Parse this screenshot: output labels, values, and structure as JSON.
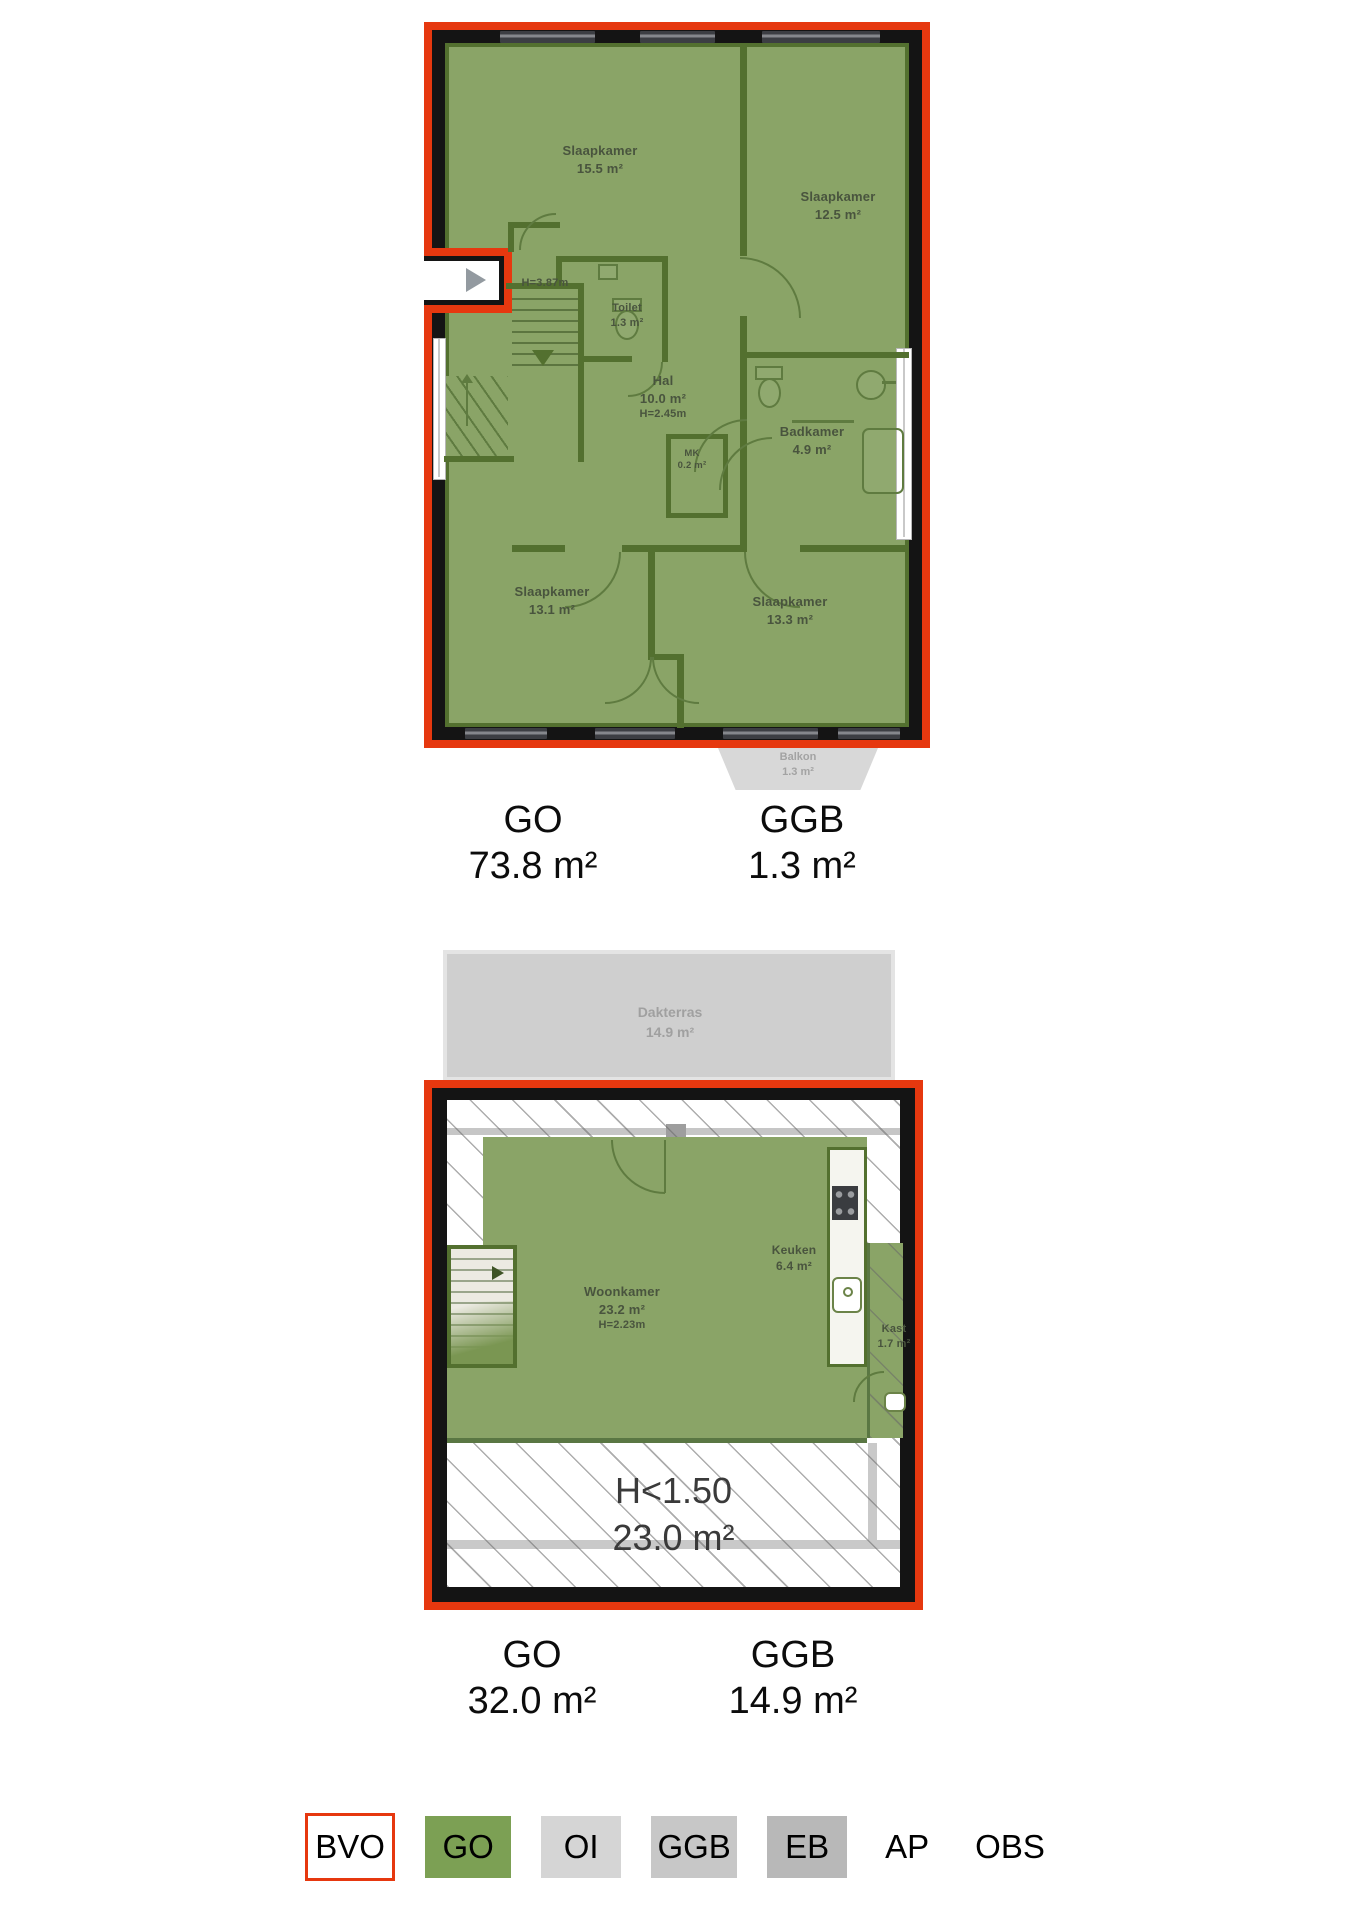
{
  "floor1": {
    "rooms": [
      {
        "name": "Slaapkamer",
        "area": "15.5 m²"
      },
      {
        "name": "Slaapkamer",
        "area": "12.5 m²"
      },
      {
        "name": "Toilet",
        "area": "1.3 m²"
      },
      {
        "name": "Hal",
        "area": "10.0 m²",
        "height": "H=2.45m"
      },
      {
        "name": "Badkamer",
        "area": "4.9 m²"
      },
      {
        "name": "MK",
        "area": "0.2 m²"
      },
      {
        "name": "Slaapkamer",
        "area": "13.1 m²"
      },
      {
        "name": "Slaapkamer",
        "area": "13.3 m²"
      }
    ],
    "vide_height": "H=3.87m",
    "balkon": {
      "name": "Balkon",
      "area": "1.3 m²"
    },
    "totals": [
      {
        "label": "GO",
        "value": "73.8 m²"
      },
      {
        "label": "GGB",
        "value": "1.3 m²"
      }
    ]
  },
  "floor2": {
    "dakterras": {
      "name": "Dakterras",
      "area": "14.9 m²"
    },
    "rooms": [
      {
        "name": "Woonkamer",
        "area": "23.2 m²",
        "height": "H=2.23m"
      },
      {
        "name": "Keuken",
        "area": "6.4 m²"
      },
      {
        "name": "Kast",
        "area": "1.7 m²"
      }
    ],
    "low_height": {
      "label": "H<1.50",
      "area": "23.0 m²"
    },
    "totals": [
      {
        "label": "GO",
        "value": "32.0 m²"
      },
      {
        "label": "GGB",
        "value": "14.9 m²"
      }
    ]
  },
  "legend": {
    "items": [
      {
        "label": "BVO"
      },
      {
        "label": "GO"
      },
      {
        "label": "OI"
      },
      {
        "label": "GGB"
      },
      {
        "label": "EB"
      },
      {
        "label": "AP"
      },
      {
        "label": "OBS"
      }
    ]
  },
  "colors": {
    "bvo_outline_red": "#e6380f",
    "room_green": "#8aa467",
    "wall_green": "#53702f",
    "wall_black": "#141414",
    "legend_go_green": "#7ca054",
    "legend_oi_gray": "#d5d5d5",
    "legend_ggb_gray": "#c7c7c7",
    "legend_eb_gray": "#b8b8b8",
    "terrace_gray": "#cfcfcf",
    "balcony_gray": "#d8d8d8",
    "label_green_text": "#49543e",
    "gray_label_text": "#a3a3a3"
  }
}
